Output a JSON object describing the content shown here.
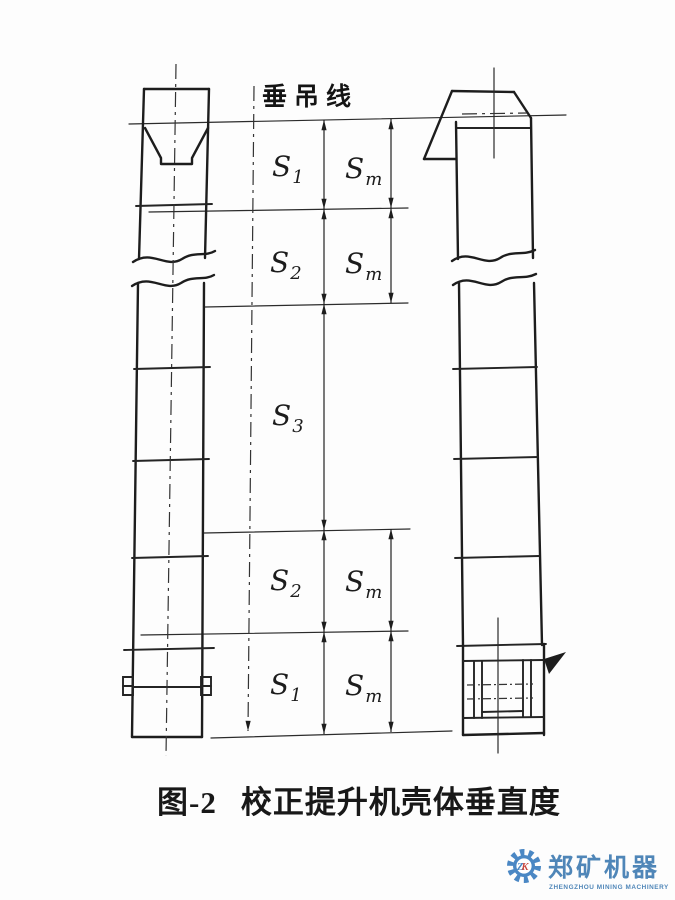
{
  "diagram": {
    "plumb_label": "垂吊线",
    "dims": [
      {
        "base": "S",
        "sub": "1"
      },
      {
        "base": "S",
        "sub": "m"
      },
      {
        "base": "S",
        "sub": "2"
      },
      {
        "base": "S",
        "sub": "m"
      },
      {
        "base": "S",
        "sub": "3"
      },
      {
        "base": "S",
        "sub": "2"
      },
      {
        "base": "S",
        "sub": "m"
      },
      {
        "base": "S",
        "sub": "1"
      },
      {
        "base": "S",
        "sub": "m"
      }
    ]
  },
  "caption": {
    "fig": "图-2",
    "title": "校正提升机壳体垂直度"
  },
  "logo": {
    "monogram_z": "Z",
    "monogram_k": "K",
    "name": "郑矿机器",
    "subtitle": "ZHENGZHOU MINING MACHINERY",
    "gear_color": "#4a87c4",
    "red_color": "#c9473f",
    "text_color": "#4f86b8"
  },
  "colors": {
    "ink": "#1d1d1d",
    "background": "#fdfdfd"
  }
}
